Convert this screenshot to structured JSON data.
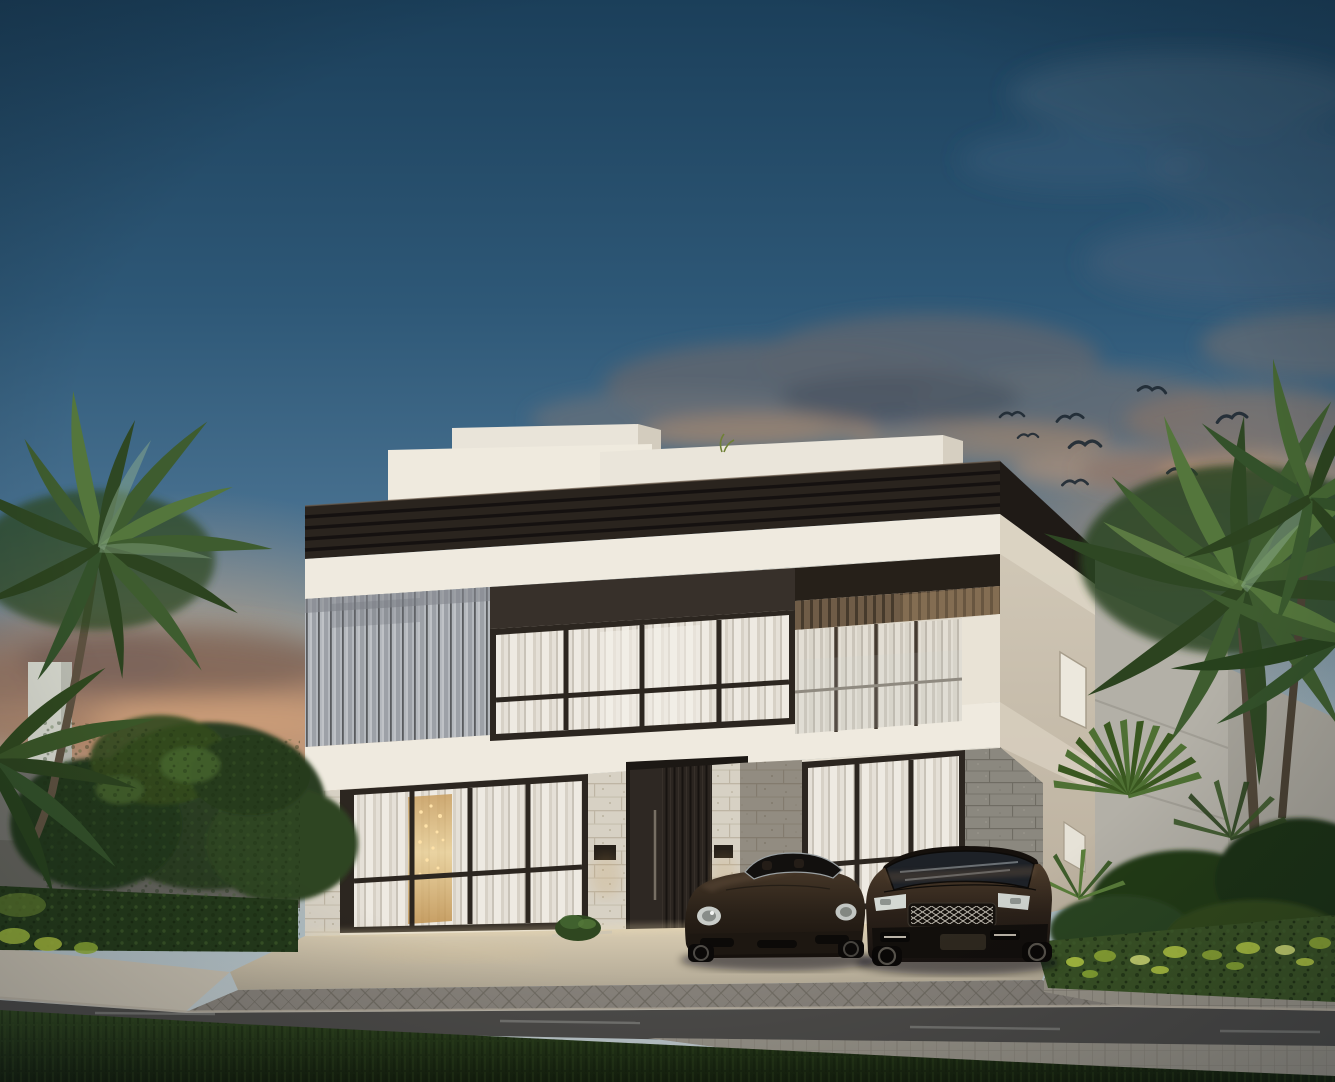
{
  "scene": {
    "type": "exterior-architectural-rendering",
    "time_of_day": "dusk",
    "weather": "partly cloudy with warm sunset glow near horizon",
    "main_subject": "modern two-storey flat-roof villa",
    "villa": {
      "storeys": 2,
      "features": [
        "dark louvered roof fascia band",
        "white stucco parapet volumes on roof",
        "vertical metal louver cladding on upper-left facade",
        "floor-to-ceiling gridded windows with sheer white curtains",
        "recessed corner balcony with glass railing and slatted wood ceiling",
        "stone-clad ground-floor piers",
        "dark vertical-slat entrance door",
        "two dark wall sconces",
        "warm interior light with chandelier behind left window",
        "small windows on shaded right side facade"
      ]
    },
    "vehicles": [
      {
        "type": "sports convertible",
        "color": "dark espresso brown",
        "position": "left of driveway",
        "facing": "front"
      },
      {
        "type": "luxury SUV",
        "color": "dark espresso brown",
        "position": "right of driveway",
        "facing": "front",
        "grille": "silver mesh"
      }
    ],
    "vegetation": [
      "tall palm tree on left",
      "dense palm cluster and fan palms on right",
      "clipped hedge rows left and right with bright yellow-green lit tips",
      "round garden trees on left",
      "round bush beside entrance",
      "lawn strip across foreground"
    ],
    "birds_count": 8,
    "street": {
      "elements": [
        "pale concrete apron with warm base lighting",
        "herringbone paver driveway",
        "stone curb",
        "asphalt road with faint lane streaks",
        "paver sidewalk strips",
        "grass verge in foreground"
      ]
    },
    "background": [
      "grey garden boundary wall on left",
      "pale stone pillar behind trees",
      "neighbouring light-grey buildings on right"
    ],
    "palette": {
      "sky_top": "#1b3f5a",
      "sky_mid": "#4a7392",
      "sky_horizon": "#b9c4c7",
      "sunset_glow": "#d99d6f",
      "cloud_slate": "#5c6570",
      "cloud_warm": "#b8906e",
      "facade_white": "#efeadf",
      "fascia_dark": "#2a241e",
      "fascia_side": "#1f1a16",
      "window_header": "#37302a",
      "window_frame": "#2c2620",
      "louver_gray": "#b4b8bd",
      "stone_light": "#d7d1c4",
      "stone_gray": "#8b887f",
      "curtain_light": "#e9e4da",
      "interior_gold": "#d3a868",
      "door_dark": "#2e2823",
      "boundary_wall": "#70706a",
      "neighbor_building": "#b3b0a7",
      "road_asphalt": "#4b4a48",
      "paver_gray": "#86817a",
      "grass_dark": "#22351a",
      "foliage_dark": "#2c4522",
      "foliage_light": "#6b8d4a",
      "hedge_accent": "#b7cc45",
      "car_body_dark": "#2b2119"
    }
  }
}
